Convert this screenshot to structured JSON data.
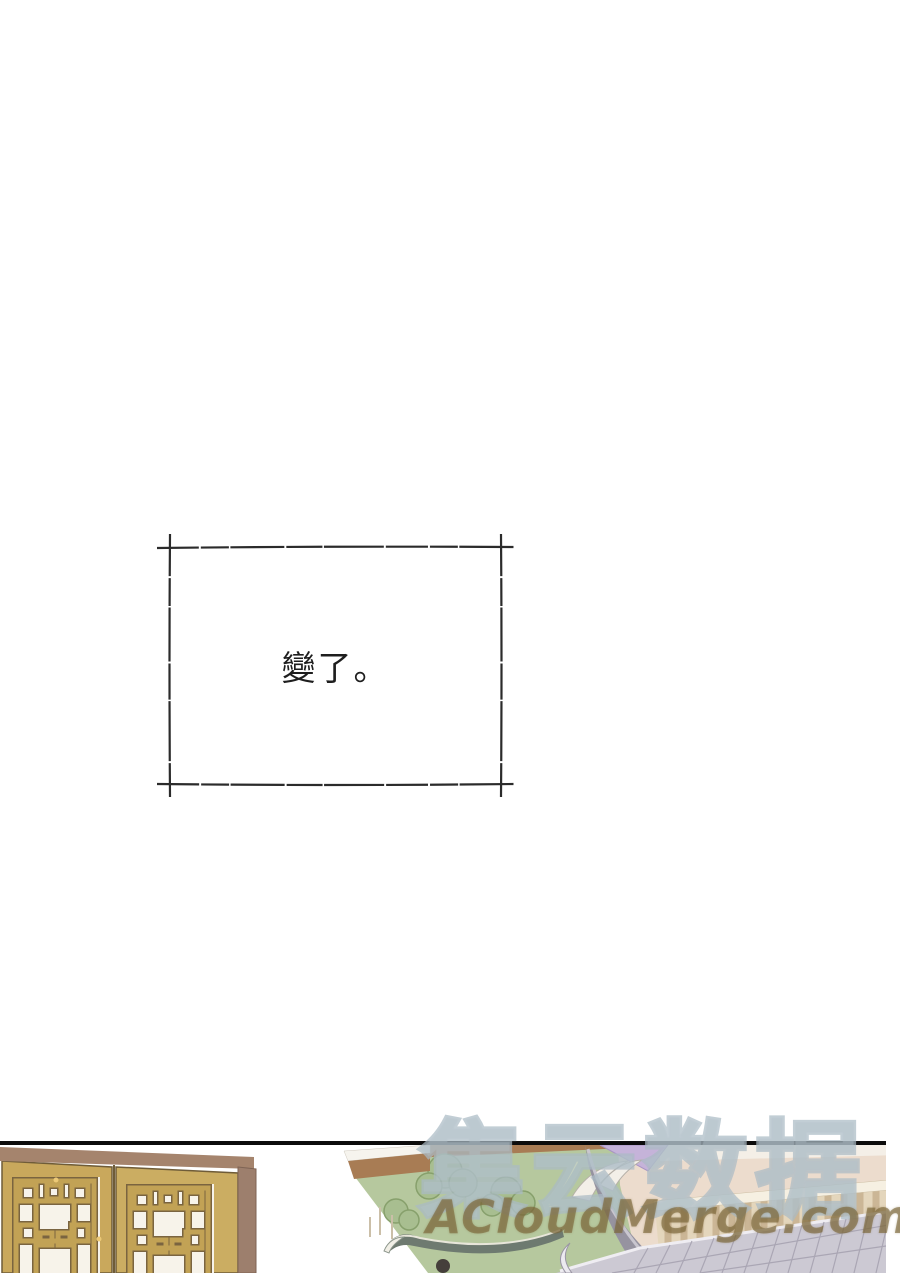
{
  "page": {
    "width": 900,
    "height": 1273,
    "background": "#ffffff",
    "kind": "comic page"
  },
  "caption_box": {
    "text": "變了。",
    "border_color": "#2b2b2b",
    "text_color": "#1e1e1e"
  },
  "panel": {
    "border_color": "#0c0c0c",
    "scene": "golden lattice double doors opening onto a green courtyard with trees and a traditional building with balustrade and tiled roofs",
    "colors": {
      "door_gold": "#c9a85c",
      "lattice_gold": "#c2a255",
      "lattice_outline": "#7a6440",
      "lattice_backing": "#f7f3ea",
      "door_frame_mauve": "#9d7f6d",
      "top_beam": "#a5846d",
      "courtyard_green": "#b6c89e",
      "tree_green": "#a8be90",
      "tree_outline": "#87a06c",
      "walkway_brown": "#a87c54",
      "building_cream": "#ecdccd",
      "lavender_accent": "#c5b3d9",
      "roof_gray": "#9693a0",
      "tiled_roof": "#ccc9d3",
      "tile_line": "#aaa6b4",
      "balustrade_fill": "#e4d6bc",
      "balustrade_post": "#cbb696",
      "figure_hair": "#453f3b"
    }
  },
  "watermark": {
    "cjk_text": "集云数据",
    "site_text": "ACloudMerge.com",
    "cjk_outline_color": "#aabac4",
    "site_color": "#7a6638"
  }
}
